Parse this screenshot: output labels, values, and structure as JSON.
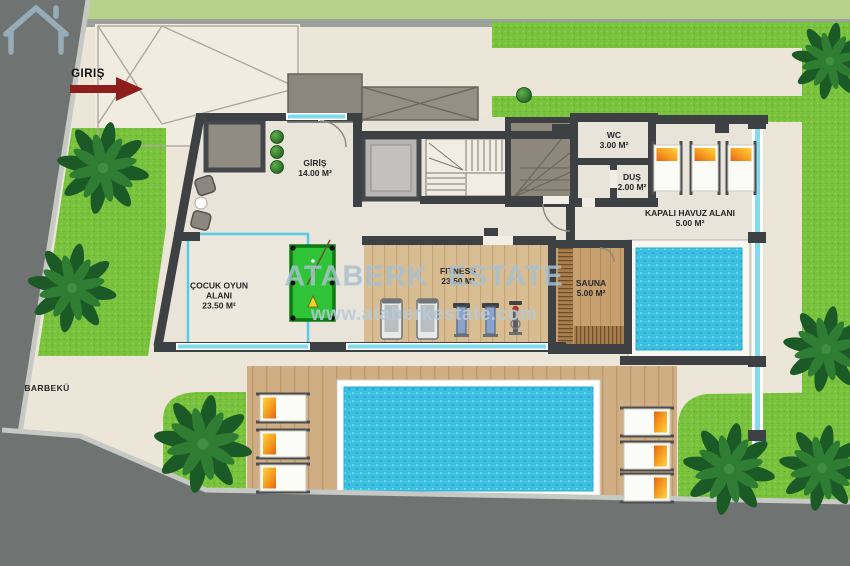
{
  "entrance": {
    "label": "GIRIŞ"
  },
  "site": {
    "barbecue": "BARBEKÜ"
  },
  "rooms": {
    "giris": {
      "name": "GİRİŞ",
      "area": "14.00 M²"
    },
    "cocuk": {
      "name": "ÇOCUK OYUN ALANI",
      "area": "23.50 M²"
    },
    "fitness": {
      "name": "FITNESS",
      "area": "23.50 M²"
    },
    "sauna": {
      "name": "SAUNA",
      "area": "5.00 M²"
    },
    "kapali_havuz": {
      "name": "KAPALI HAVUZ ALANI",
      "area": "5.00 M²"
    },
    "wc": {
      "name": "WC",
      "area": "3.00 M²"
    },
    "dus": {
      "name": "DUŞ",
      "area": "2.00 M²"
    }
  },
  "watermark": {
    "brand": "ATABERK ESTATE",
    "url": "www.ataberkestate.com"
  },
  "colors": {
    "grass": "#79c23d",
    "water": "#3cc0e2",
    "road": "#6f7472",
    "deck_wood": "#cfae83",
    "wall": "#3e4144",
    "window_glass": "#7fdcef",
    "entrance_arrow": "#8e1d1c",
    "billiard_green": "#2fc437"
  }
}
